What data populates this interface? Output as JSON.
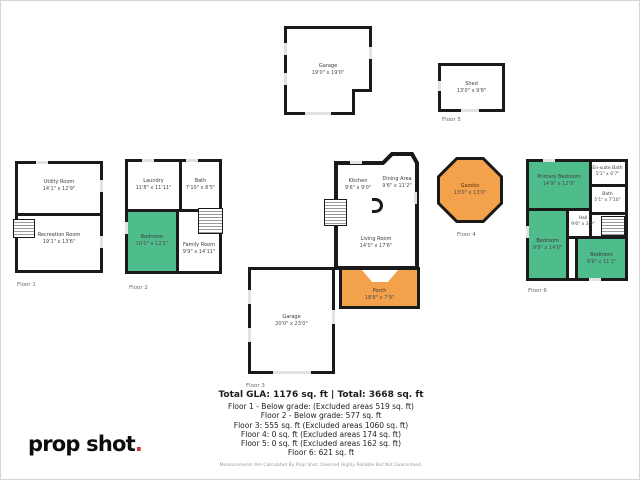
{
  "colors": {
    "wall": "#1a1a1a",
    "green": "#4fbd8b",
    "orange": "#f4a14b",
    "dot": "#d93131"
  },
  "logo": {
    "text": "prop shot",
    "dot": "."
  },
  "plans": [
    {
      "label": "Floor 1",
      "rooms": [
        {
          "name": "Utility Room",
          "dims": "14'1\" x 12'9\""
        },
        {
          "name": "Recreation Room",
          "dims": "19'1\" x 13'6\""
        }
      ]
    },
    {
      "label": "Floor 2",
      "rooms": [
        {
          "name": "Laundry",
          "dims": "11'8\" x 11'11\""
        },
        {
          "name": "Bath",
          "dims": "7'10\" x 8'5\""
        },
        {
          "name": "Bedroom",
          "dims": "10'0\" x 12'1\""
        },
        {
          "name": "Family Room",
          "dims": "9'9\" x 14'11\""
        }
      ]
    },
    {
      "label": "",
      "rooms": [
        {
          "name": "Garage",
          "dims": "19'0\" x 19'0\""
        }
      ]
    },
    {
      "label": "Floor 5",
      "rooms": [
        {
          "name": "Shed",
          "dims": "13'0\" x 9'8\""
        }
      ]
    },
    {
      "label": "Floor 3",
      "rooms": [
        {
          "name": "Kitchen",
          "dims": "9'6\" x 9'0\""
        },
        {
          "name": "Dining Area",
          "dims": "9'6\" x 11'2\""
        },
        {
          "name": "Living Room",
          "dims": "14'0\" x 17'6\""
        },
        {
          "name": "Porch",
          "dims": "18'8\" x 7'9\""
        },
        {
          "name": "Garage",
          "dims": "20'0\" x 23'0\""
        }
      ]
    },
    {
      "label": "Floor 4",
      "rooms": [
        {
          "name": "Gazebo",
          "dims": "13'0\" x 13'0\""
        }
      ]
    },
    {
      "label": "Floor 6",
      "rooms": [
        {
          "name": "Primary Bedroom",
          "dims": "14'9\" x 12'9\""
        },
        {
          "name": "En-suite Bath",
          "dims": "5'1\" x 6'7\""
        },
        {
          "name": "Bath",
          "dims": "5'1\" x 7'10\""
        },
        {
          "name": "Hall",
          "dims": "9'6\" x 3'0\""
        },
        {
          "name": "Bedroom",
          "dims": "9'9\" x 14'0\""
        },
        {
          "name": "Bedroom",
          "dims": "9'9\" x 11'1\""
        }
      ]
    }
  ],
  "summary": {
    "title": "Total GLA: 1176 sq. ft | Total: 3668 sq. ft",
    "lines": [
      "Floor 1 - Below grade: (Excluded areas 519 sq. ft)",
      "Floor 2 - Below grade: 577 sq. ft",
      "Floor 3: 555 sq. ft (Excluded areas 1060 sq. ft)",
      "Floor 4: 0 sq. ft (Excluded areas 174 sq. ft)",
      "Floor 5: 0 sq. ft (Excluded areas 162 sq. ft)",
      "Floor 6: 621 sq. ft"
    ],
    "disclaimer": "Measurements Are Calculated By Prop Shot. Deemed Highly Reliable But Not Guaranteed."
  }
}
